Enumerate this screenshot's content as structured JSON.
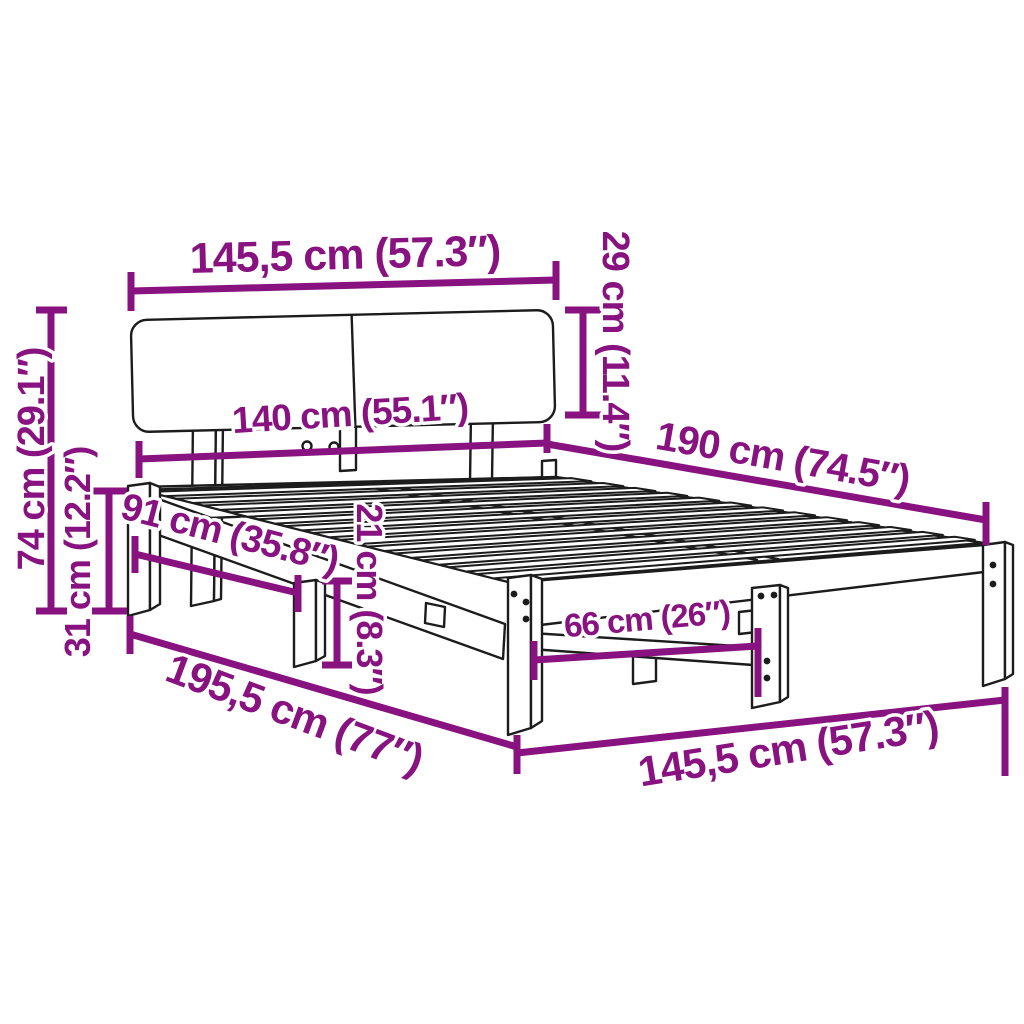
{
  "diagram": {
    "colors": {
      "accent": "#88127F",
      "line": "#1C1C1C",
      "background": "#FFFFFF"
    },
    "dimensions": {
      "headboard_width": "145,5 cm (57.3″)",
      "headboard_panel_height": "29 cm (11.4″)",
      "inner_width": "140 cm (55.1″)",
      "inner_length": "190 cm (74.5″)",
      "total_height": "74 cm (29.1″)",
      "base_height": "31 cm (12.2″)",
      "head_section_length": "91 cm (35.8″)",
      "rail_height": "21 cm (8.3″)",
      "leg_spacing": "66 cm (26″)",
      "total_length": "195,5 cm (77″)",
      "total_width": "145,5 cm (57.3″)"
    }
  }
}
